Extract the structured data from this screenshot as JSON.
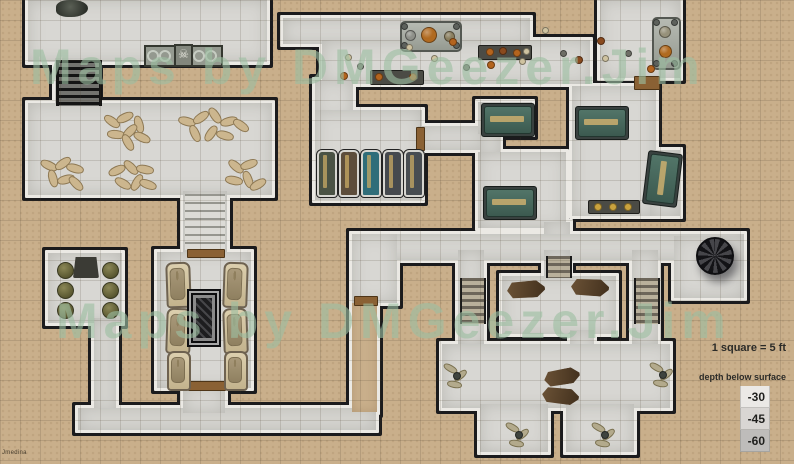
{
  "watermark": {
    "line1": "Maps by DMGeezer.Jim",
    "line2": "Maps by DMGeezer.Jim",
    "color": "#9dbfa2"
  },
  "legend": {
    "scale_text": "1 square = 5 ft",
    "depth_label": "depth below surface",
    "swatches": [
      {
        "value": "-30",
        "color": "#ebe9e6"
      },
      {
        "value": "-45",
        "color": "#d9d6d3"
      },
      {
        "value": "-60",
        "color": "#bebcba"
      }
    ]
  },
  "signature": "Jmedina",
  "icons": {
    "skull_icon": "☠"
  },
  "palette": {
    "sand": "#c9af8b",
    "stone": "#d8d7d3",
    "wall": "#1b1b1d",
    "wall_light": "#ebe9e4",
    "door": "#8a6134",
    "green_sarcophagus": "#47695f",
    "dark_coffin": "#4e3a26",
    "debris_orange": "#b4641e",
    "debris_bone": "#cfc3a0",
    "debris_gray": "#6e6e66",
    "debris_rust": "#8a4a1e",
    "gold": "#c9a23e"
  },
  "map": {
    "grid_size": 20,
    "rooms": [
      {
        "id": "ossuary-room",
        "x": 28,
        "y": 0,
        "w": 239,
        "h": 62,
        "fill": "stone"
      },
      {
        "id": "nw-stairwell",
        "x": 55,
        "y": 58,
        "w": 42,
        "h": 50,
        "fill": "stone"
      },
      {
        "id": "body-hall",
        "x": 28,
        "y": 103,
        "w": 244,
        "h": 92,
        "fill": "stone"
      },
      {
        "id": "chapel-stairwell",
        "x": 183,
        "y": 191,
        "w": 44,
        "h": 64,
        "fill": "stone"
      },
      {
        "id": "chapel",
        "x": 157,
        "y": 252,
        "w": 94,
        "h": 136,
        "fill": "stone"
      },
      {
        "id": "guard-room",
        "x": 48,
        "y": 253,
        "w": 74,
        "h": 70,
        "fill": "stone"
      },
      {
        "id": "guard-corridor",
        "x": 94,
        "y": 318,
        "w": 22,
        "h": 95,
        "fill": "stone"
      },
      {
        "id": "south-corridor",
        "x": 78,
        "y": 408,
        "w": 298,
        "h": 22,
        "fill": "stone"
      },
      {
        "id": "chapel-exit-corridor",
        "x": 183,
        "y": 385,
        "w": 42,
        "h": 28,
        "fill": "stone"
      },
      {
        "id": "secret-passage",
        "x": 352,
        "y": 300,
        "w": 25,
        "h": 112,
        "fill": "sand"
      },
      {
        "id": "great-hall-north",
        "x": 283,
        "y": 18,
        "w": 247,
        "h": 26,
        "fill": "stone"
      },
      {
        "id": "great-hall",
        "x": 322,
        "y": 40,
        "w": 268,
        "h": 44,
        "fill": "stone"
      },
      {
        "id": "ne-altar-room",
        "x": 600,
        "y": 0,
        "w": 80,
        "h": 78,
        "fill": "stone"
      },
      {
        "id": "hall-to-coffins",
        "x": 315,
        "y": 80,
        "w": 38,
        "h": 40,
        "fill": "stone"
      },
      {
        "id": "coffin-room",
        "x": 315,
        "y": 110,
        "w": 107,
        "h": 90,
        "fill": "stone"
      },
      {
        "id": "coffin-corridor",
        "x": 418,
        "y": 126,
        "w": 66,
        "h": 24,
        "fill": "stone"
      },
      {
        "id": "sarcophagus-alcove",
        "x": 478,
        "y": 102,
        "w": 54,
        "h": 32,
        "fill": "stone"
      },
      {
        "id": "alcove-passage",
        "x": 480,
        "y": 128,
        "w": 20,
        "h": 30,
        "fill": "stone"
      },
      {
        "id": "mid-tomb-room",
        "x": 478,
        "y": 152,
        "w": 88,
        "h": 76,
        "fill": "stone"
      },
      {
        "id": "tomb-corridor-stub",
        "x": 544,
        "y": 222,
        "w": 26,
        "h": 22,
        "fill": "stone"
      },
      {
        "id": "green-tomb-room",
        "x": 572,
        "y": 86,
        "w": 84,
        "h": 130,
        "fill": "stone"
      },
      {
        "id": "green-tomb-annex",
        "x": 650,
        "y": 150,
        "w": 30,
        "h": 66,
        "fill": "stone"
      },
      {
        "id": "main-east-corridor",
        "x": 352,
        "y": 234,
        "w": 392,
        "h": 26,
        "fill": "stone"
      },
      {
        "id": "west-junction",
        "x": 352,
        "y": 234,
        "w": 45,
        "h": 69,
        "fill": "stone"
      },
      {
        "id": "spiral-stair-room",
        "x": 674,
        "y": 236,
        "w": 70,
        "h": 62,
        "fill": "stone"
      },
      {
        "id": "crypt-north-stub",
        "x": 544,
        "y": 250,
        "w": 26,
        "h": 30,
        "fill": "stone"
      },
      {
        "id": "crypt-north",
        "x": 502,
        "y": 276,
        "w": 114,
        "h": 58,
        "fill": "stone"
      },
      {
        "id": "crypt-connector",
        "x": 570,
        "y": 330,
        "w": 24,
        "h": 40,
        "fill": "stone"
      },
      {
        "id": "crypt-west-stairs-hall",
        "x": 458,
        "y": 250,
        "w": 26,
        "h": 96,
        "fill": "stone"
      },
      {
        "id": "crypt-east-stairs-hall",
        "x": 632,
        "y": 250,
        "w": 26,
        "h": 96,
        "fill": "stone"
      },
      {
        "id": "crypt-main",
        "x": 442,
        "y": 344,
        "w": 228,
        "h": 64,
        "fill": "stone"
      },
      {
        "id": "crypt-arm-west",
        "x": 480,
        "y": 404,
        "w": 68,
        "h": 48,
        "fill": "stone"
      },
      {
        "id": "crypt-arm-east",
        "x": 566,
        "y": 404,
        "w": 68,
        "h": 48,
        "fill": "stone"
      }
    ],
    "stairs": [
      {
        "x": 56,
        "y": 60,
        "w": 40,
        "h": 46,
        "tone": "dark"
      },
      {
        "x": 185,
        "y": 194,
        "w": 40,
        "h": 56,
        "tone": "light"
      },
      {
        "x": 546,
        "y": 256,
        "w": 22,
        "h": 22,
        "tone": "mid"
      },
      {
        "x": 460,
        "y": 278,
        "w": 22,
        "h": 46,
        "tone": "mid"
      },
      {
        "x": 634,
        "y": 278,
        "w": 22,
        "h": 46,
        "tone": "mid"
      }
    ],
    "doors": [
      {
        "x": 634,
        "y": 76,
        "w": 24,
        "h": 12
      },
      {
        "x": 416,
        "y": 127,
        "w": 7,
        "h": 22
      },
      {
        "x": 354,
        "y": 296,
        "w": 22,
        "h": 8
      },
      {
        "x": 188,
        "y": 381,
        "w": 36,
        "h": 8
      },
      {
        "x": 187,
        "y": 249,
        "w": 36,
        "h": 7
      }
    ],
    "furniture": {
      "altars": [
        [
          400,
          21,
          58,
          27
        ],
        [
          652,
          17,
          25,
          49
        ]
      ],
      "orbs": [
        [
          409,
          34,
          9,
          "#8e9089"
        ],
        [
          428,
          34,
          14,
          "#b06a20"
        ],
        [
          448,
          35,
          9,
          "#8a7f5f"
        ],
        [
          664,
          31,
          10,
          "#96917a"
        ],
        [
          664,
          50,
          11,
          "#b06a20"
        ]
      ],
      "knobs": [
        [
          403,
          25
        ],
        [
          455,
          25
        ],
        [
          403,
          44
        ],
        [
          455,
          44
        ],
        [
          655,
          21
        ],
        [
          673,
          21
        ],
        [
          655,
          62
        ],
        [
          673,
          62
        ]
      ],
      "dark_tables": [
        [
          478,
          45,
          52,
          13
        ],
        [
          370,
          70,
          52,
          13
        ],
        [
          588,
          200,
          50,
          12
        ]
      ],
      "trap_table": [
        73,
        257,
        26,
        21
      ],
      "green_sarcophagi": [
        [
          484,
          106,
          46,
          26,
          0
        ],
        [
          578,
          109,
          46,
          26,
          0
        ],
        [
          648,
          155,
          27,
          46,
          7
        ],
        [
          486,
          189,
          46,
          26,
          0
        ]
      ],
      "dark_coffins": [
        [
          507,
          281,
          38,
          17,
          -4
        ],
        [
          571,
          279,
          38,
          17,
          3
        ],
        [
          544,
          369,
          36,
          16,
          -10
        ],
        [
          542,
          388,
          37,
          16,
          6
        ]
      ],
      "coffin_slabs": [
        [
          317,
          150,
          16,
          43,
          "#4a5244"
        ],
        [
          339,
          150,
          16,
          43,
          "#5d4d3b"
        ],
        [
          361,
          150,
          16,
          43,
          "#2f6d79"
        ],
        [
          383,
          150,
          16,
          43,
          "#45494e"
        ],
        [
          404,
          150,
          16,
          43,
          "#484d52"
        ]
      ],
      "chapel_sarcophagi": [
        [
          166,
          262,
          21,
          42,
          -2
        ],
        [
          223,
          262,
          21,
          42,
          2
        ],
        [
          166,
          308,
          21,
          42,
          2
        ],
        [
          223,
          308,
          21,
          42,
          -2
        ],
        [
          167,
          351,
          20,
          36,
          0
        ],
        [
          224,
          351,
          20,
          36,
          0
        ]
      ],
      "rug": [
        187,
        289,
        34,
        58
      ],
      "stools": [
        [
          57,
          262
        ],
        [
          57,
          282
        ],
        [
          57,
          302
        ],
        [
          102,
          262
        ],
        [
          102,
          282
        ],
        [
          102,
          302
        ]
      ],
      "spiral_stair": [
        696,
        237,
        34
      ],
      "niches": [
        [
          144,
          45,
          29,
          18
        ],
        [
          190,
          45,
          29,
          18
        ]
      ],
      "skull_niche": [
        174,
        44,
        15,
        19
      ],
      "swirls": [
        [
          151,
          54
        ],
        [
          163,
          54
        ],
        [
          197,
          54
        ],
        [
          209,
          54
        ]
      ],
      "rubble": [
        56,
        0,
        32,
        17
      ],
      "body_clusters": [
        {
          "cx": 127,
          "cy": 129,
          "bodies": [
            [
              -16,
              -9,
              35
            ],
            [
              -3,
              -13,
              -25
            ],
            [
              11,
              -6,
              75
            ],
            [
              -12,
              4,
              5
            ],
            [
              2,
              1,
              -45
            ],
            [
              14,
              7,
              25
            ],
            [
              0,
              12,
              60
            ]
          ]
        },
        {
          "cx": 212,
          "cy": 126,
          "bodies": [
            [
              -26,
              -6,
              15
            ],
            [
              -12,
              -10,
              -35
            ],
            [
              2,
              -12,
              55
            ],
            [
              16,
              -6,
              -15
            ],
            [
              28,
              -2,
              35
            ],
            [
              -18,
              6,
              65
            ],
            [
              -2,
              6,
              -55
            ],
            [
              12,
              8,
              15
            ]
          ]
        },
        {
          "cx": 62,
          "cy": 174,
          "bodies": [
            [
              -14,
              -10,
              25
            ],
            [
              0,
              -12,
              -35
            ],
            [
              12,
              -7,
              15
            ],
            [
              -10,
              3,
              75
            ],
            [
              3,
              4,
              -15
            ],
            [
              13,
              8,
              45
            ]
          ]
        },
        {
          "cx": 132,
          "cy": 177,
          "bodies": [
            [
              -16,
              -8,
              -25
            ],
            [
              -2,
              -11,
              45
            ],
            [
              12,
              -9,
              10
            ],
            [
              -10,
              5,
              30
            ],
            [
              4,
              4,
              -60
            ],
            [
              15,
              6,
              20
            ]
          ]
        },
        {
          "cx": 245,
          "cy": 175,
          "bodies": [
            [
              -10,
              -10,
              40
            ],
            [
              3,
              -12,
              -20
            ],
            [
              -12,
              4,
              10
            ],
            [
              2,
              3,
              70
            ],
            [
              12,
              8,
              -30
            ]
          ]
        }
      ],
      "skeleton_clusters": [
        [
          456,
          375
        ],
        [
          662,
          374
        ],
        [
          518,
          434
        ],
        [
          604,
          434
        ]
      ],
      "debris": [
        [
          433,
          57,
          "b"
        ],
        [
          452,
          41,
          "o"
        ],
        [
          465,
          66,
          "g"
        ],
        [
          521,
          60,
          "b"
        ],
        [
          544,
          29,
          "b"
        ],
        [
          562,
          52,
          "g"
        ],
        [
          578,
          59,
          "r"
        ],
        [
          604,
          57,
          "b"
        ],
        [
          627,
          52,
          "g"
        ],
        [
          650,
          68,
          "o"
        ],
        [
          600,
          40,
          "r"
        ],
        [
          347,
          56,
          "b"
        ],
        [
          359,
          65,
          "g"
        ],
        [
          343,
          75,
          "o"
        ],
        [
          408,
          46,
          "b"
        ],
        [
          490,
          64,
          "o"
        ],
        [
          489,
          51,
          "o"
        ],
        [
          502,
          50,
          "r"
        ],
        [
          516,
          52,
          "o"
        ],
        [
          525,
          50,
          "b"
        ],
        [
          378,
          76,
          "o"
        ],
        [
          412,
          76,
          "o"
        ],
        [
          597,
          206,
          "g2"
        ],
        [
          612,
          206,
          "g2"
        ],
        [
          627,
          206,
          "g2"
        ]
      ],
      "debris_colors": {
        "o": "#b4641e",
        "b": "#cfc3a0",
        "g": "#6e6e66",
        "r": "#8a4a1e",
        "g2": "#c9a23e"
      }
    }
  }
}
